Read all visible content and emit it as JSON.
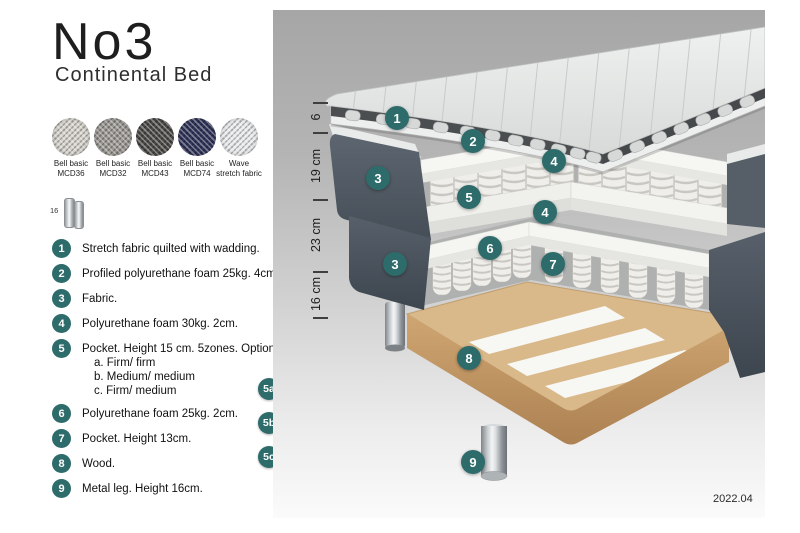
{
  "header": {
    "title": "No3",
    "subtitle": "Continental Bed"
  },
  "swatches": [
    {
      "name": "Bell basic",
      "code": "MCD36",
      "color": "#d6d3cc"
    },
    {
      "name": "Bell basic",
      "code": "MCD32",
      "color": "#9b9893"
    },
    {
      "name": "Bell basic",
      "code": "MCD43",
      "color": "#4b4a47"
    },
    {
      "name": "Bell basic",
      "code": "MCD74",
      "color": "#30345a"
    },
    {
      "name": "Wave",
      "code": "stretch fabric",
      "color": "#e9ebec"
    }
  ],
  "leg_icon": {
    "label": "16"
  },
  "parts": [
    {
      "num": "1",
      "text": "Stretch fabric quilted with wadding."
    },
    {
      "num": "2",
      "text": "Profiled polyurethane foam 25kg. 4cm."
    },
    {
      "num": "3",
      "text": "Fabric."
    },
    {
      "num": "4",
      "text": "Polyurethane foam 30kg. 2cm."
    },
    {
      "num": "5",
      "text": "Pocket. Height 15 cm. 5zones. Option:",
      "options": [
        "a. Firm/ firm",
        "b. Medium/ medium",
        "c. Firm/ medium"
      ]
    },
    {
      "num": "6",
      "text": "Polyurethane foam 25kg. 2cm."
    },
    {
      "num": "7",
      "text": "Pocket. Height 13cm."
    },
    {
      "num": "8",
      "text": "Wood."
    },
    {
      "num": "9",
      "text": "Metal leg. Height 16cm."
    }
  ],
  "firmness_legend": {
    "rows": [
      {
        "label": "5a",
        "cells": [
          {
            "text": "F",
            "variant": "dark"
          },
          {
            "text": "F",
            "variant": "dark"
          }
        ]
      },
      {
        "label": "5b",
        "cells": [
          {
            "text": "M",
            "variant": "light"
          },
          {
            "text": "M",
            "variant": "light"
          }
        ]
      },
      {
        "label": "5c",
        "cells": [
          {
            "text": "F",
            "variant": "dark"
          },
          {
            "text": "M",
            "variant": "light"
          }
        ]
      }
    ]
  },
  "diagram": {
    "dimensions": [
      {
        "label": "6"
      },
      {
        "label": "19 cm"
      },
      {
        "label": "23 cm"
      },
      {
        "label": "16 cm"
      }
    ],
    "callouts": {
      "c1": "1",
      "c2": "2",
      "c3a": "3",
      "c3b": "3",
      "c4a": "4",
      "c4b": "4",
      "c5": "5",
      "c6": "6",
      "c7": "7",
      "c8": "8",
      "c9": "9"
    },
    "version": "2022.04",
    "accent_color": "#2e6b6b",
    "fabric_color": "#57606a",
    "wood_color": "#d9b88a"
  }
}
